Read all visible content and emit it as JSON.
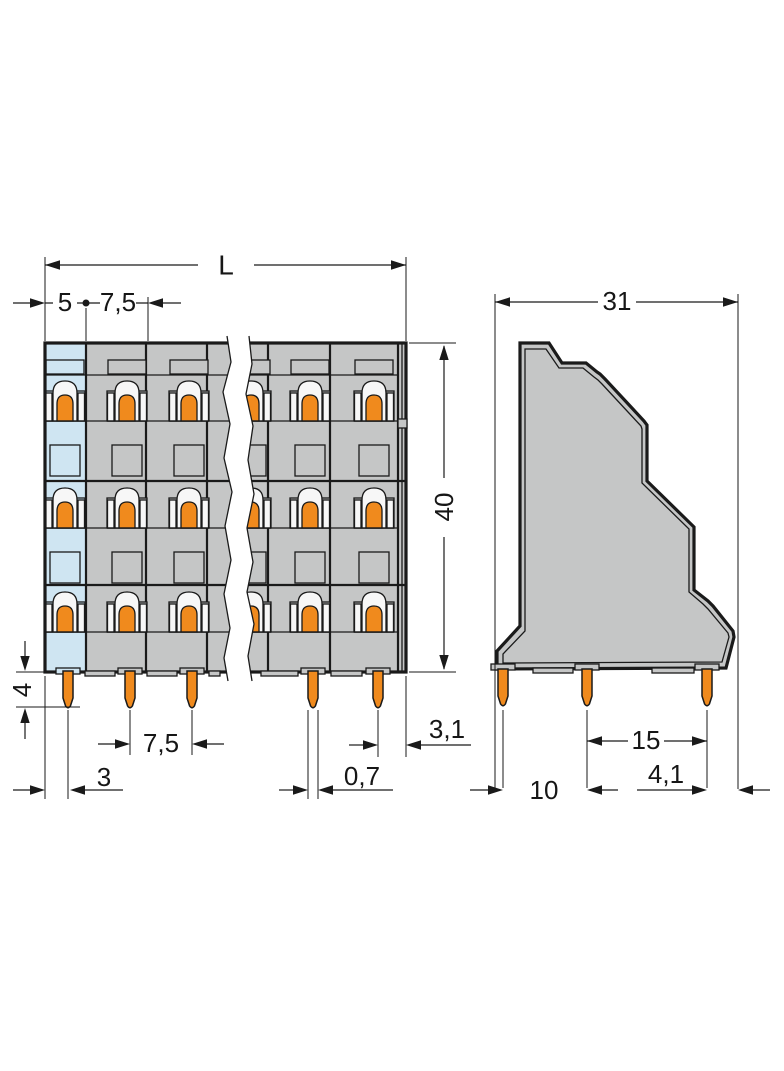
{
  "title": "terminal-block-dimensional-drawing",
  "dims": {
    "overall_length": "L",
    "end_section_width": "5",
    "pole_pitch": "7,5",
    "height": "40",
    "pin_length": "4",
    "pin_pitch": "7,5",
    "first_pin_offset": "3",
    "pin_width": "0,7",
    "last_pin_offset": "3,1",
    "depth": "31",
    "pin_row_span": "15",
    "pin_row_edge_offset": "4,1",
    "pin_row_first_offset": "10"
  },
  "colors": {
    "body_gray": "#c5c6c6",
    "end_blue": "#cfe5f2",
    "clamp_orange": "#f08a1d",
    "line": "#1a1a1a",
    "background": "#ffffff"
  }
}
